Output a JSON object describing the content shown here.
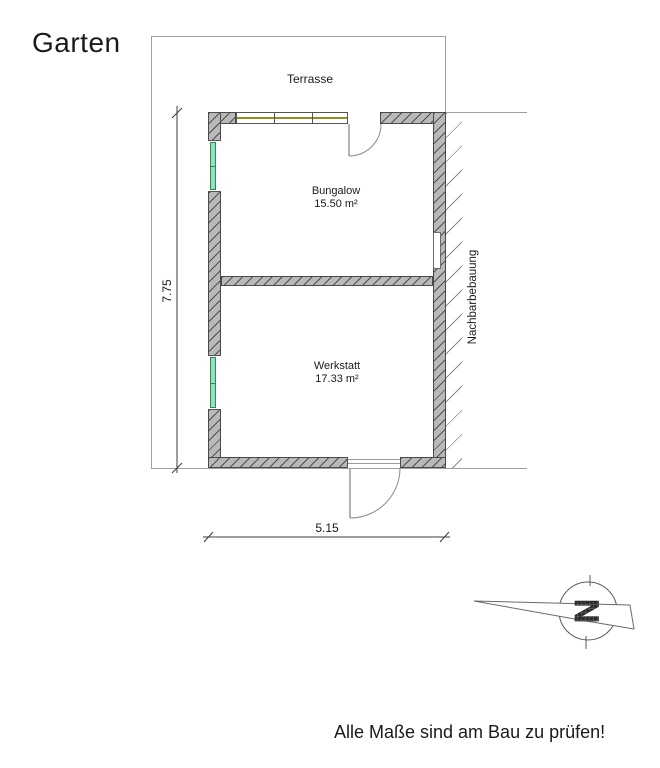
{
  "labels": {
    "garten": "Garten",
    "terrasse": "Terrasse",
    "nachbarbebauung": "Nachbarbebauung",
    "footer_note": "Alle Maße sind am Bau zu prüfen!"
  },
  "rooms": [
    {
      "name": "Bungalow",
      "area": "15.50 m²"
    },
    {
      "name": "Werkstatt",
      "area": "17.33 m²"
    }
  ],
  "dimensions": {
    "building_height_m": "7.75",
    "building_width_m": "5.15"
  },
  "compass": {
    "letter": "N",
    "icon": "north-arrow-icon"
  },
  "colors": {
    "wall_fill": "#b9b9b9",
    "wall_hatch": "#4f4f4f",
    "wall_outline": "#4a4a4a",
    "boundary_line": "#a0a0a0",
    "window_glass_fill": "#93dec6",
    "window_glass_frame": "#2e8b45",
    "top_window_glazing": "#8f9020",
    "text": "#1a1a1a"
  }
}
